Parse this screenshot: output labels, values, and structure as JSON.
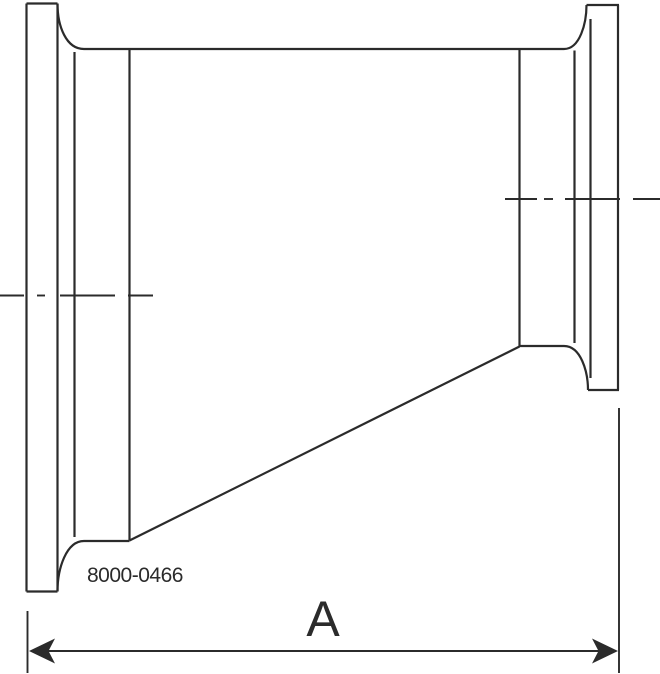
{
  "drawing": {
    "part_number": "8000-0466",
    "dimension": {
      "label": "A",
      "extension_lines": [
        {
          "side": "left",
          "x": 27.5,
          "y1": 611,
          "y2": 673
        },
        {
          "side": "right",
          "x": 619,
          "y1": 408,
          "y2": 673
        }
      ],
      "line": {
        "y": 651,
        "x1": 48,
        "x2": 599
      },
      "arrowheads": [
        {
          "side": "left",
          "points": "29,651 55,638.5 48.5,651 55,663.5"
        },
        {
          "side": "right",
          "points": "618,651 592,638.5 598.5,651 592,663.5"
        }
      ]
    },
    "colors": {
      "line": "#2b2b2b",
      "background": "#ffffff"
    },
    "canvas": {
      "width": 660,
      "height": 674
    },
    "outline": {
      "lines": [
        {
          "name": "left-flange-face",
          "x1": 26.5,
          "y1": 3.5,
          "x2": 26.5,
          "y2": 591.5
        },
        {
          "name": "left-flange-top",
          "x1": 26.5,
          "y1": 3.5,
          "x2": 57.5,
          "y2": 3.5
        },
        {
          "name": "left-flange-back",
          "x1": 57.5,
          "y1": 3.5,
          "x2": 57.5,
          "y2": 591.5
        },
        {
          "name": "left-flange-bottom",
          "x1": 26.5,
          "y1": 591.5,
          "x2": 57.5,
          "y2": 591.5
        },
        {
          "name": "left-ferrule-inner-edge",
          "x1": 74.5,
          "y1": 52,
          "x2": 74.5,
          "y2": 537
        },
        {
          "name": "left-weld-seam",
          "x1": 129.5,
          "y1": 49,
          "x2": 129.5,
          "y2": 540.5
        },
        {
          "name": "body-top",
          "x1": 84,
          "y1": 49,
          "x2": 564,
          "y2": 49
        },
        {
          "name": "left-tube-bottom",
          "x1": 84,
          "y1": 541,
          "x2": 129.5,
          "y2": 541
        },
        {
          "name": "cone-bottom-taper",
          "x1": 129.5,
          "y1": 540.5,
          "x2": 519.5,
          "y2": 346.5
        },
        {
          "name": "right-weld-seam",
          "x1": 519.5,
          "y1": 49,
          "x2": 519.5,
          "y2": 346.5
        },
        {
          "name": "right-tube-bottom",
          "x1": 519.5,
          "y1": 346,
          "x2": 564,
          "y2": 346
        },
        {
          "name": "right-ferrule-inner-edge",
          "x1": 574.5,
          "y1": 50.5,
          "x2": 574.5,
          "y2": 343
        },
        {
          "name": "right-flange-back",
          "x1": 590.5,
          "y1": 19,
          "x2": 590.5,
          "y2": 378
        },
        {
          "name": "right-flange-top",
          "x1": 586.5,
          "y1": 5,
          "x2": 619,
          "y2": 5
        },
        {
          "name": "right-flange-face",
          "x1": 618,
          "y1": 5,
          "x2": 618,
          "y2": 390
        },
        {
          "name": "right-flange-bottom",
          "x1": 588,
          "y1": 390,
          "x2": 619,
          "y2": 390
        }
      ],
      "curves": [
        {
          "name": "top-left-fillet",
          "d": "M 57.5 3.5 C 57.5 26 66 49 84 49"
        },
        {
          "name": "bottom-left-fillet",
          "d": "M 57.5 591.5 C 57.5 569 66 541 84 541"
        },
        {
          "name": "top-right-fillet",
          "d": "M 586.5 5 C 586.5 23 580 49 564 49"
        },
        {
          "name": "bottom-right-fillet",
          "d": "M 588 390 C 588 372 581 346 564 346"
        }
      ]
    },
    "centerlines": [
      {
        "name": "left-port-centerline",
        "y": 295.5,
        "segments": [
          [
            0,
            24
          ],
          [
            37,
            45
          ],
          [
            60,
            115
          ],
          [
            128,
            153
          ]
        ]
      },
      {
        "name": "right-port-centerline",
        "y": 199,
        "segments": [
          [
            505,
            537
          ],
          [
            544,
            553
          ],
          [
            565,
            620
          ],
          [
            633,
            660
          ]
        ]
      }
    ]
  }
}
